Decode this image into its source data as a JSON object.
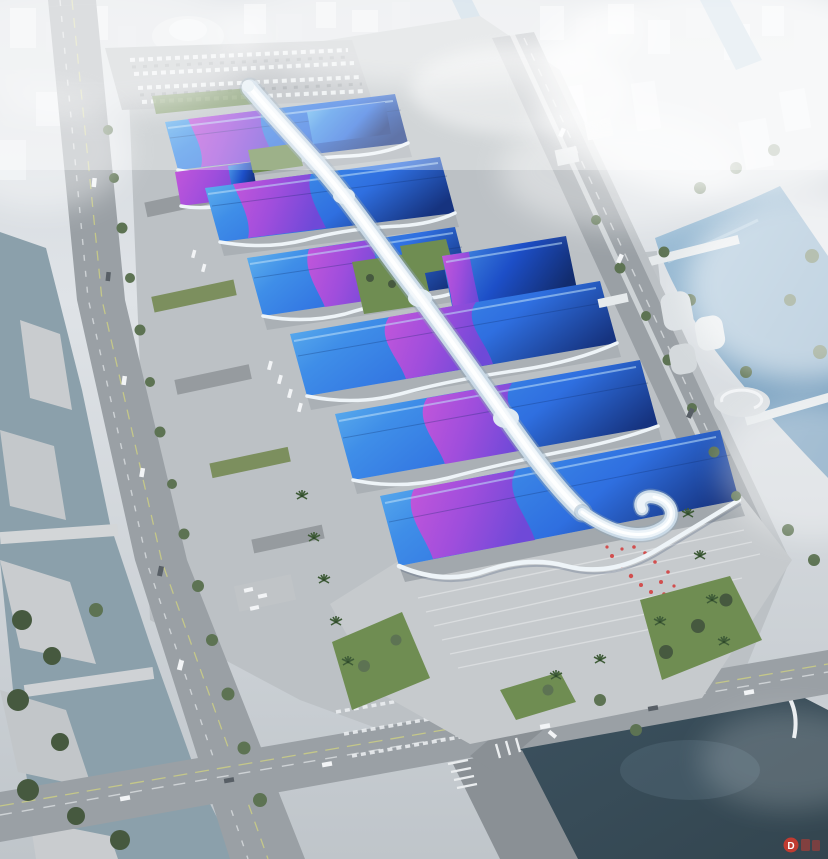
{
  "scene": {
    "watermark": {
      "text": "D"
    }
  },
  "palette": {
    "roof_blue_light": "#6fc2f0",
    "roof_blue": "#2f6fe0",
    "roof_blue_deep": "#16337f",
    "ribbon_magenta": "#c457da",
    "ribbon_violet": "#6f49d8",
    "spine_white": "#edf4f9",
    "water_left": "#8ba0ab",
    "water_right": "#85abc8",
    "lake_dark": "#33454f",
    "road_gray": "#9aa0a5",
    "plaza_gray": "#c6cacd",
    "site_gray": "#bcc1c5",
    "tree_green": "#5d7353",
    "lawn_green": "#6f8d52",
    "city_haze": "#dfe3e7",
    "watermark_red": "#cf3a2e"
  }
}
